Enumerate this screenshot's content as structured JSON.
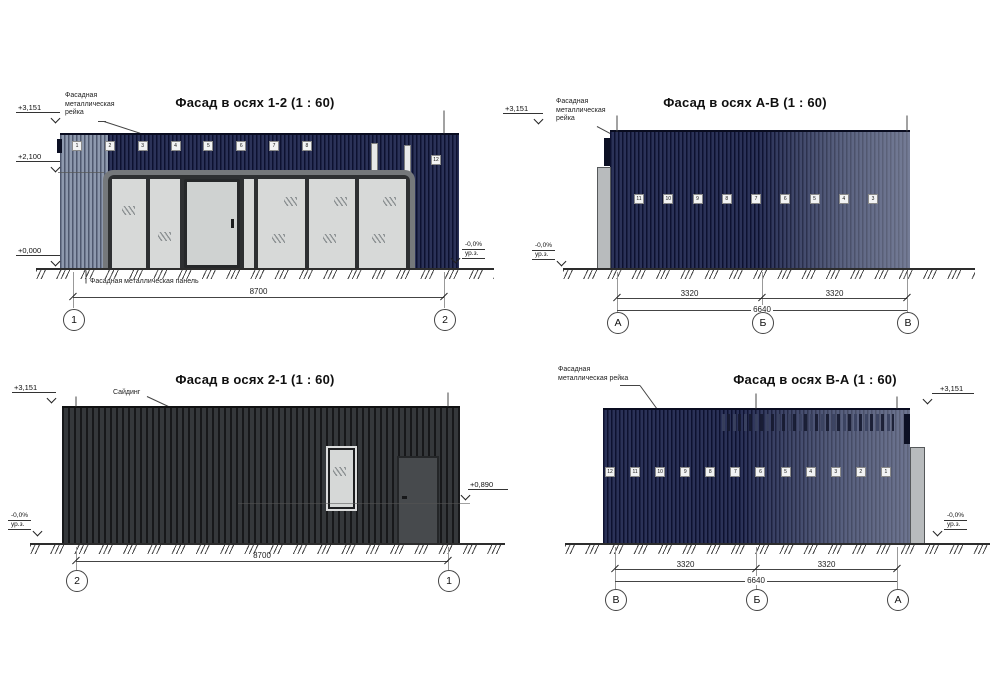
{
  "colors": {
    "navy_wall": "#2b3258",
    "charcoal_wall": "#2c2e30",
    "glass": "#d7d9d8",
    "storefront_frame": "#75787b",
    "gray_panel": "#b8bbbd"
  },
  "facade12": {
    "title": "Фасад в осях 1-2 (1 : 60)",
    "note_rejka": "Фасадная\nметаллическая\nрейка",
    "note_panel": "Фасадная металлическая панель",
    "lvl_top": "+3,151",
    "lvl_mid": "+2,100",
    "lvl_zero": "+0,000",
    "gl": "-0,0%",
    "gl_sub": "ур.з.",
    "dim_total": "8700",
    "axis_left": "1",
    "axis_right": "2",
    "tags": [
      "1",
      "2",
      "3",
      "4",
      "5",
      "6",
      "7",
      "8"
    ],
    "tag_right": "12"
  },
  "facadeAB": {
    "title": "Фасад в осях А-В (1 : 60)",
    "note_rejka": "Фасадная\nметаллическая\nрейка",
    "lvl_top": "+3,151",
    "gl": "-0,0%",
    "gl_sub": "ур.з.",
    "dim_a": "3320",
    "dim_b": "3320",
    "dim_total": "6640",
    "axes": [
      "А",
      "Б",
      "В"
    ],
    "tags": [
      "11",
      "10",
      "9",
      "8",
      "7",
      "6",
      "5",
      "4",
      "3"
    ]
  },
  "facade21": {
    "title": "Фасад в осях 2-1 (1 : 60)",
    "note_siding": "Сайдинг",
    "lvl_top": "+3,151",
    "lvl_door": "+0,890",
    "gl": "-0,0%",
    "gl_sub": "ур.з.",
    "dim_total": "8700",
    "axis_left": "2",
    "axis_right": "1"
  },
  "facadeBA": {
    "title": "Фасад в осях В-А (1 : 60)",
    "note_rejka": "Фасадная\nметаллическая рейка",
    "lvl_top": "+3,151",
    "gl": "-0,0%",
    "gl_sub": "ур.з.",
    "dim_a": "3320",
    "dim_b": "3320",
    "dim_total": "6640",
    "axes": [
      "В",
      "Б",
      "А"
    ],
    "tags": [
      "12",
      "11",
      "10",
      "9",
      "8",
      "7",
      "6",
      "5",
      "4",
      "3",
      "2",
      "1"
    ]
  }
}
